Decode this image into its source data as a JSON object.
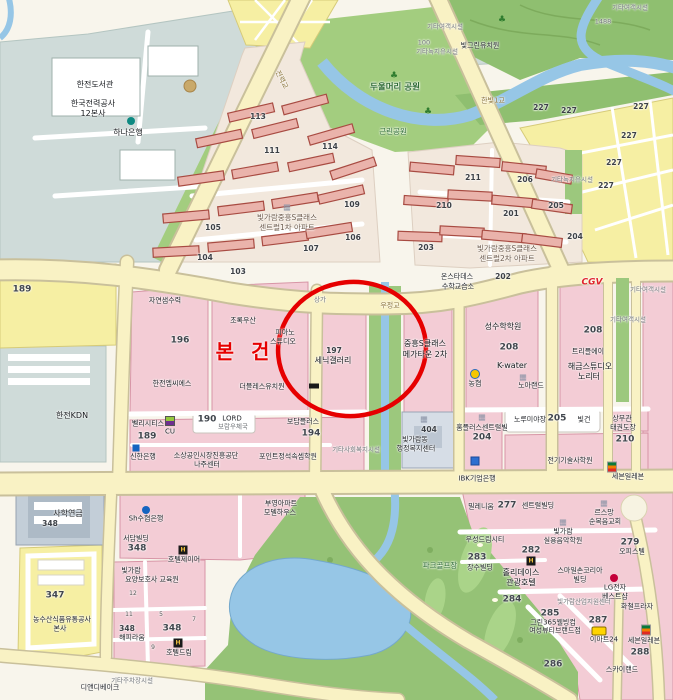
{
  "annotation": {
    "subject_label": "본 건",
    "circle_color": "#e60000",
    "text_color": "#e60000"
  },
  "colors": {
    "road_major": "#f9f2c4",
    "road_casing": "#c9c09b",
    "water": "#96c6e6",
    "park_green": "#a3cd7f",
    "hill_green": "#8fbf70",
    "golf_green": "#95c276",
    "parcel_pink": "#f3ccd5",
    "parcel_yellow": "#f6efa3",
    "campus_gray": "#cfdbd9",
    "complex_beige": "#f2e8dd",
    "apartment_red": "#a84b42"
  },
  "labels": [
    {
      "t": "한전도서관",
      "x": 95,
      "y": 85,
      "c": "poi"
    },
    {
      "t": "한국전력공사",
      "x": 93,
      "y": 104,
      "c": "poi"
    },
    {
      "t": "12본사",
      "x": 93,
      "y": 114,
      "c": "poi"
    },
    {
      "t": "하나은행",
      "x": 128,
      "y": 133,
      "c": "poi"
    },
    {
      "t": "한전KDN",
      "x": 72,
      "y": 416,
      "c": "poi"
    },
    {
      "t": "두울머리 공원",
      "x": 395,
      "y": 88,
      "c": "green"
    },
    {
      "t": "근린공원",
      "x": 393,
      "y": 132,
      "c": "green-sm"
    },
    {
      "t": "전력교",
      "x": 281,
      "y": 80,
      "c": "roadname",
      "r": 63
    },
    {
      "t": "한빛1교",
      "x": 493,
      "y": 101,
      "c": "roadname"
    },
    {
      "t": "기타여객시설",
      "x": 445,
      "y": 27,
      "c": "gray"
    },
    {
      "t": "100",
      "x": 424,
      "y": 43,
      "c": "gray"
    },
    {
      "t": "기타녹지유시설",
      "x": 437,
      "y": 52,
      "c": "gray"
    },
    {
      "t": "빛그린유치원",
      "x": 480,
      "y": 46,
      "c": "poi-sm"
    },
    {
      "t": "1488",
      "x": 603,
      "y": 22,
      "c": "gray"
    },
    {
      "t": "기타여객시설",
      "x": 630,
      "y": 8,
      "c": "gray"
    },
    {
      "t": "227",
      "x": 541,
      "y": 108,
      "c": "num"
    },
    {
      "t": "227",
      "x": 569,
      "y": 111,
      "c": "num"
    },
    {
      "t": "227",
      "x": 641,
      "y": 107,
      "c": "num"
    },
    {
      "t": "227",
      "x": 629,
      "y": 136,
      "c": "num"
    },
    {
      "t": "227",
      "x": 614,
      "y": 163,
      "c": "num"
    },
    {
      "t": "227",
      "x": 606,
      "y": 186,
      "c": "num"
    },
    {
      "t": "113",
      "x": 258,
      "y": 117,
      "c": "num"
    },
    {
      "t": "111",
      "x": 272,
      "y": 151,
      "c": "num"
    },
    {
      "t": "114",
      "x": 330,
      "y": 147,
      "c": "num"
    },
    {
      "t": "109",
      "x": 352,
      "y": 205,
      "c": "num"
    },
    {
      "t": "105",
      "x": 213,
      "y": 228,
      "c": "num"
    },
    {
      "t": "106",
      "x": 353,
      "y": 238,
      "c": "num"
    },
    {
      "t": "107",
      "x": 311,
      "y": 249,
      "c": "num"
    },
    {
      "t": "104",
      "x": 205,
      "y": 258,
      "c": "num"
    },
    {
      "t": "103",
      "x": 238,
      "y": 272,
      "c": "num"
    },
    {
      "t": "빛가람중흥S클래스",
      "x": 287,
      "y": 218,
      "c": "complex"
    },
    {
      "t": "센트럴1차 아파트",
      "x": 287,
      "y": 228,
      "c": "complex"
    },
    {
      "t": "210",
      "x": 444,
      "y": 206,
      "c": "num"
    },
    {
      "t": "211",
      "x": 473,
      "y": 178,
      "c": "num"
    },
    {
      "t": "206",
      "x": 525,
      "y": 180,
      "c": "num"
    },
    {
      "t": "205",
      "x": 556,
      "y": 206,
      "c": "num"
    },
    {
      "t": "201",
      "x": 511,
      "y": 214,
      "c": "num"
    },
    {
      "t": "204",
      "x": 575,
      "y": 237,
      "c": "num"
    },
    {
      "t": "203",
      "x": 426,
      "y": 248,
      "c": "num"
    },
    {
      "t": "202",
      "x": 503,
      "y": 277,
      "c": "num"
    },
    {
      "t": "빛가람중흥S클래스",
      "x": 507,
      "y": 249,
      "c": "complex"
    },
    {
      "t": "센트럴2차 아파트",
      "x": 507,
      "y": 259,
      "c": "complex"
    },
    {
      "t": "기타녹지유시설",
      "x": 572,
      "y": 180,
      "c": "gray"
    },
    {
      "t": "온스타데스",
      "x": 457,
      "y": 277,
      "c": "poi-sm"
    },
    {
      "t": "수학교습소",
      "x": 458,
      "y": 287,
      "c": "poi-sm"
    },
    {
      "t": "자연샘수력",
      "x": 165,
      "y": 301,
      "c": "poi-sm"
    },
    {
      "t": "196",
      "x": 180,
      "y": 341,
      "c": "numlg"
    },
    {
      "t": "한전엠씨에스",
      "x": 172,
      "y": 384,
      "c": "poi-sm"
    },
    {
      "t": "초록우산",
      "x": 243,
      "y": 321,
      "c": "poi-sm"
    },
    {
      "t": "피아노",
      "x": 285,
      "y": 333,
      "c": "poi-sm"
    },
    {
      "t": "스튜디오",
      "x": 283,
      "y": 342,
      "c": "poi-sm"
    },
    {
      "t": "더블레스유치원",
      "x": 262,
      "y": 387,
      "c": "poi-sm"
    },
    {
      "t": "상가",
      "x": 320,
      "y": 300,
      "c": "gray"
    },
    {
      "t": "우정교",
      "x": 390,
      "y": 306,
      "c": "roadname"
    },
    {
      "t": "197",
      "x": 334,
      "y": 351,
      "c": "num"
    },
    {
      "t": "세닉갤러리",
      "x": 333,
      "y": 361,
      "c": "poi"
    },
    {
      "t": "중흥S클래스",
      "x": 425,
      "y": 344,
      "c": "poi"
    },
    {
      "t": "메가타운 2차",
      "x": 425,
      "y": 355,
      "c": "poi"
    },
    {
      "t": "성수학학원",
      "x": 503,
      "y": 327,
      "c": "poi"
    },
    {
      "t": "208",
      "x": 509,
      "y": 348,
      "c": "numlg"
    },
    {
      "t": "K-water",
      "x": 512,
      "y": 366,
      "c": "poi"
    },
    {
      "t": "농협",
      "x": 475,
      "y": 384,
      "c": "poi-sm"
    },
    {
      "t": "노아랜드",
      "x": 531,
      "y": 386,
      "c": "poi-sm"
    },
    {
      "t": "CGV",
      "x": 592,
      "y": 283,
      "c": "cgv"
    },
    {
      "t": "208",
      "x": 593,
      "y": 331,
      "c": "numlg"
    },
    {
      "t": "트리플에이",
      "x": 588,
      "y": 352,
      "c": "poi-sm"
    },
    {
      "t": "해금스튜디오",
      "x": 590,
      "y": 367,
      "c": "poi"
    },
    {
      "t": "노리터",
      "x": 589,
      "y": 377,
      "c": "poi"
    },
    {
      "t": "기타여객시설",
      "x": 648,
      "y": 290,
      "c": "gray"
    },
    {
      "t": "기타여객시설",
      "x": 628,
      "y": 320,
      "c": "gray"
    },
    {
      "t": "벨리시티스",
      "x": 148,
      "y": 424,
      "c": "poi-sm"
    },
    {
      "t": "CU",
      "x": 170,
      "y": 432,
      "c": "poi-sm"
    },
    {
      "t": "189",
      "x": 147,
      "y": 437,
      "c": "numlg"
    },
    {
      "t": "190",
      "x": 207,
      "y": 420,
      "c": "numlg"
    },
    {
      "t": "LORD",
      "x": 232,
      "y": 419,
      "c": "poi-sm"
    },
    {
      "t": "보람우체국",
      "x": 233,
      "y": 427,
      "c": "gray"
    },
    {
      "t": "보담플러스",
      "x": 303,
      "y": 422,
      "c": "poi-sm"
    },
    {
      "t": "194",
      "x": 311,
      "y": 434,
      "c": "numlg"
    },
    {
      "t": "신한은행",
      "x": 143,
      "y": 457,
      "c": "poi-sm"
    },
    {
      "t": "소상공인시장진흥공단",
      "x": 206,
      "y": 456,
      "c": "poi-sm"
    },
    {
      "t": "나주센터",
      "x": 207,
      "y": 465,
      "c": "poi-sm"
    },
    {
      "t": "포인트정석속셈학원",
      "x": 288,
      "y": 457,
      "c": "poi-sm"
    },
    {
      "t": "기타사회복지시설",
      "x": 356,
      "y": 450,
      "c": "gray"
    },
    {
      "t": "404",
      "x": 429,
      "y": 430,
      "c": "num"
    },
    {
      "t": "빛가람동",
      "x": 415,
      "y": 440,
      "c": "poi-sm"
    },
    {
      "t": "행정복지센터",
      "x": 416,
      "y": 449,
      "c": "poi-sm"
    },
    {
      "t": "홈플러스센트럴빌",
      "x": 482,
      "y": 428,
      "c": "poi-sm"
    },
    {
      "t": "204",
      "x": 482,
      "y": 438,
      "c": "numlg"
    },
    {
      "t": "노루미야장",
      "x": 530,
      "y": 420,
      "c": "poi-sm"
    },
    {
      "t": "205",
      "x": 557,
      "y": 419,
      "c": "numlg"
    },
    {
      "t": "빛건",
      "x": 584,
      "y": 420,
      "c": "poi-sm"
    },
    {
      "t": "상무관",
      "x": 622,
      "y": 419,
      "c": "poi-sm"
    },
    {
      "t": "태권도장",
      "x": 623,
      "y": 428,
      "c": "poi-sm"
    },
    {
      "t": "210",
      "x": 625,
      "y": 440,
      "c": "numlg"
    },
    {
      "t": "전기기술사학원",
      "x": 570,
      "y": 461,
      "c": "poi-sm"
    },
    {
      "t": "IBK기업은행",
      "x": 477,
      "y": 479,
      "c": "poi-sm"
    },
    {
      "t": "세븐일레븐",
      "x": 628,
      "y": 477,
      "c": "poi-sm"
    },
    {
      "t": "사학연금",
      "x": 68,
      "y": 514,
      "c": "poi"
    },
    {
      "t": "348",
      "x": 50,
      "y": 524,
      "c": "num"
    },
    {
      "t": "347",
      "x": 55,
      "y": 596,
      "c": "numlg"
    },
    {
      "t": "농수산식품유통공사",
      "x": 62,
      "y": 620,
      "c": "poi-sm"
    },
    {
      "t": "본사",
      "x": 60,
      "y": 629,
      "c": "poi-sm"
    },
    {
      "t": "디앤디베이크",
      "x": 100,
      "y": 688,
      "c": "poi-sm"
    },
    {
      "t": "기타주차장시설",
      "x": 132,
      "y": 681,
      "c": "gray"
    },
    {
      "t": "Sh수협은행",
      "x": 146,
      "y": 519,
      "c": "poi-sm"
    },
    {
      "t": "서담빌딩",
      "x": 136,
      "y": 539,
      "c": "poi-sm"
    },
    {
      "t": "348",
      "x": 137,
      "y": 549,
      "c": "numlg"
    },
    {
      "t": "호텔제이어",
      "x": 184,
      "y": 560,
      "c": "poi-sm"
    },
    {
      "t": "빛가람",
      "x": 131,
      "y": 571,
      "c": "poi-sm"
    },
    {
      "t": "요양보호사 교육원",
      "x": 152,
      "y": 580,
      "c": "poi-sm"
    },
    {
      "t": "348",
      "x": 127,
      "y": 629,
      "c": "num"
    },
    {
      "t": "해피라움",
      "x": 132,
      "y": 638,
      "c": "poi-sm"
    },
    {
      "t": "348",
      "x": 172,
      "y": 629,
      "c": "numlg"
    },
    {
      "t": "호텔드림",
      "x": 179,
      "y": 653,
      "c": "poi-sm"
    },
    {
      "t": "12",
      "x": 133,
      "y": 594,
      "c": "tiny"
    },
    {
      "t": "11",
      "x": 129,
      "y": 615,
      "c": "tiny"
    },
    {
      "t": "5",
      "x": 161,
      "y": 615,
      "c": "tiny"
    },
    {
      "t": "7",
      "x": 194,
      "y": 620,
      "c": "tiny"
    },
    {
      "t": "9",
      "x": 153,
      "y": 648,
      "c": "tiny"
    },
    {
      "t": "부영아파트",
      "x": 281,
      "y": 504,
      "c": "poi-sm"
    },
    {
      "t": "모델하우스",
      "x": 280,
      "y": 513,
      "c": "poi-sm"
    },
    {
      "t": "파크골프장",
      "x": 440,
      "y": 566,
      "c": "green-sm"
    },
    {
      "t": "밀레니움",
      "x": 481,
      "y": 507,
      "c": "poi-sm"
    },
    {
      "t": "277",
      "x": 507,
      "y": 506,
      "c": "numlg"
    },
    {
      "t": "센트럴빌딩",
      "x": 538,
      "y": 506,
      "c": "poi-sm"
    },
    {
      "t": "르스망",
      "x": 604,
      "y": 513,
      "c": "poi-sm"
    },
    {
      "t": "순복음교회",
      "x": 605,
      "y": 522,
      "c": "poi-sm"
    },
    {
      "t": "우성드림시티",
      "x": 485,
      "y": 540,
      "c": "poi-sm"
    },
    {
      "t": "282",
      "x": 531,
      "y": 551,
      "c": "numlg"
    },
    {
      "t": "홀리데이스",
      "x": 521,
      "y": 573,
      "c": "poi"
    },
    {
      "t": "관광호텔",
      "x": 521,
      "y": 583,
      "c": "poi"
    },
    {
      "t": "빛가람",
      "x": 563,
      "y": 532,
      "c": "poi-sm"
    },
    {
      "t": "실용음악학원",
      "x": 563,
      "y": 541,
      "c": "poi-sm"
    },
    {
      "t": "283",
      "x": 477,
      "y": 558,
      "c": "numlg"
    },
    {
      "t": "장수빌딩",
      "x": 480,
      "y": 568,
      "c": "poi-sm"
    },
    {
      "t": "스마일손코리아",
      "x": 580,
      "y": 571,
      "c": "poi-sm"
    },
    {
      "t": "빌딩",
      "x": 580,
      "y": 580,
      "c": "poi-sm"
    },
    {
      "t": "279",
      "x": 630,
      "y": 543,
      "c": "numlg"
    },
    {
      "t": "오피스텔",
      "x": 632,
      "y": 552,
      "c": "poi-sm"
    },
    {
      "t": "LG전자",
      "x": 615,
      "y": 588,
      "c": "poi-sm"
    },
    {
      "t": "베스트샵",
      "x": 615,
      "y": 597,
      "c": "poi-sm"
    },
    {
      "t": "284",
      "x": 512,
      "y": 600,
      "c": "numlg"
    },
    {
      "t": "빛가람산업지원센터",
      "x": 584,
      "y": 602,
      "c": "gray"
    },
    {
      "t": "화철프라자",
      "x": 637,
      "y": 607,
      "c": "poi-sm"
    },
    {
      "t": "285",
      "x": 550,
      "y": 614,
      "c": "numlg"
    },
    {
      "t": "그린365웰빙컴",
      "x": 553,
      "y": 623,
      "c": "poi-sm"
    },
    {
      "t": "여성뷰티브랜드점",
      "x": 555,
      "y": 631,
      "c": "poi-sm"
    },
    {
      "t": "287",
      "x": 598,
      "y": 621,
      "c": "numlg"
    },
    {
      "t": "이마트24",
      "x": 604,
      "y": 640,
      "c": "poi-sm"
    },
    {
      "t": "세븐일레븐",
      "x": 644,
      "y": 641,
      "c": "poi-sm"
    },
    {
      "t": "288",
      "x": 640,
      "y": 653,
      "c": "numlg"
    },
    {
      "t": "286",
      "x": 553,
      "y": 665,
      "c": "numlg"
    },
    {
      "t": "스카이랜드",
      "x": 622,
      "y": 670,
      "c": "poi-sm"
    },
    {
      "t": "189",
      "x": 22,
      "y": 290,
      "c": "numlg"
    }
  ],
  "icons": [
    {
      "k": "hana",
      "x": 131,
      "y": 121
    },
    {
      "k": "tree",
      "g": "♣",
      "x": 394,
      "y": 76
    },
    {
      "k": "tree",
      "g": "♣",
      "x": 428,
      "y": 112
    },
    {
      "k": "tree",
      "g": "♣",
      "x": 502,
      "y": 20
    },
    {
      "k": "bldg",
      "g": "▦",
      "x": 287,
      "y": 207
    },
    {
      "k": "bldg",
      "g": "▦",
      "x": 424,
      "y": 419
    },
    {
      "k": "bldg",
      "g": "▦",
      "x": 482,
      "y": 417
    },
    {
      "k": "bldg",
      "g": "▦",
      "x": 604,
      "y": 503
    },
    {
      "k": "bldg",
      "g": "▦",
      "x": 523,
      "y": 377
    },
    {
      "k": "bldg",
      "g": "▦",
      "x": 563,
      "y": 522
    },
    {
      "k": "cu",
      "x": 170,
      "y": 421
    },
    {
      "k": "nh",
      "x": 475,
      "y": 374
    },
    {
      "k": "sh",
      "x": 146,
      "y": 510
    },
    {
      "k": "shinhan",
      "x": 136,
      "y": 448
    },
    {
      "k": "hotel",
      "g": "H",
      "x": 183,
      "y": 550
    },
    {
      "k": "hotel",
      "g": "H",
      "x": 178,
      "y": 643
    },
    {
      "k": "hotel",
      "g": "H",
      "x": 531,
      "y": 561
    },
    {
      "k": "seven",
      "x": 612,
      "y": 467
    },
    {
      "k": "seven",
      "x": 646,
      "y": 630
    },
    {
      "k": "emart",
      "x": 599,
      "y": 631
    },
    {
      "k": "lg",
      "x": 614,
      "y": 578
    },
    {
      "k": "blackrect",
      "x": 314,
      "y": 386
    },
    {
      "k": "bluebox",
      "x": 475,
      "y": 461
    }
  ]
}
